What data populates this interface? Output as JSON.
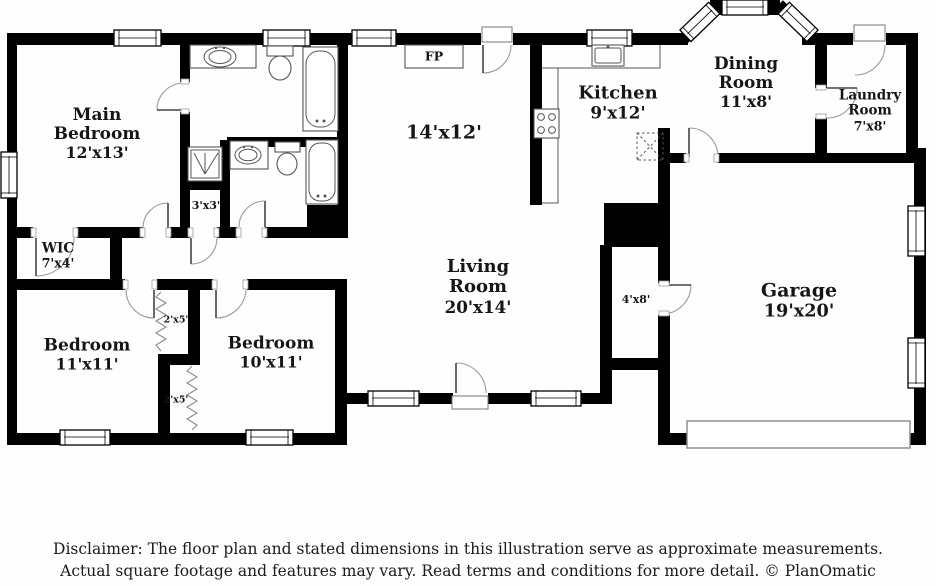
{
  "colors": {
    "wall": "#000000",
    "text": "#161616",
    "fixture_line": "#555555",
    "door_arc": "#9a9a9a"
  },
  "rooms": [
    {
      "name": "Main Bedroom",
      "dims": "12'x13'"
    },
    {
      "name": "WIC",
      "dims": "7'x4'"
    },
    {
      "name": "Bedroom",
      "dims": "11'x11'"
    },
    {
      "name": "Bedroom",
      "dims": "10'x11'"
    },
    {
      "name": "",
      "dims": "14'x12'"
    },
    {
      "name": "Living Room",
      "dims": "20'x14'"
    },
    {
      "name": "Kitchen",
      "dims": "9'x12'"
    },
    {
      "name": "Dining Room",
      "dims": "11'x8'"
    },
    {
      "name": "Laundry Room",
      "dims": "7'x8'"
    },
    {
      "name": "Garage",
      "dims": "19'x20'"
    }
  ],
  "closets": [
    {
      "dims": "3'x3'"
    },
    {
      "dims": "2'x5'"
    },
    {
      "dims": "2'x5'"
    },
    {
      "dims": "4'x8'"
    }
  ],
  "fireplace_label": "FP",
  "disclaimer": {
    "line1": "Disclaimer: The floor plan and stated dimensions in this illustration serve as approximate measurements.",
    "line2": "Actual square footage and features may vary. Read terms and conditions for more detail. © PlanOmatic"
  }
}
